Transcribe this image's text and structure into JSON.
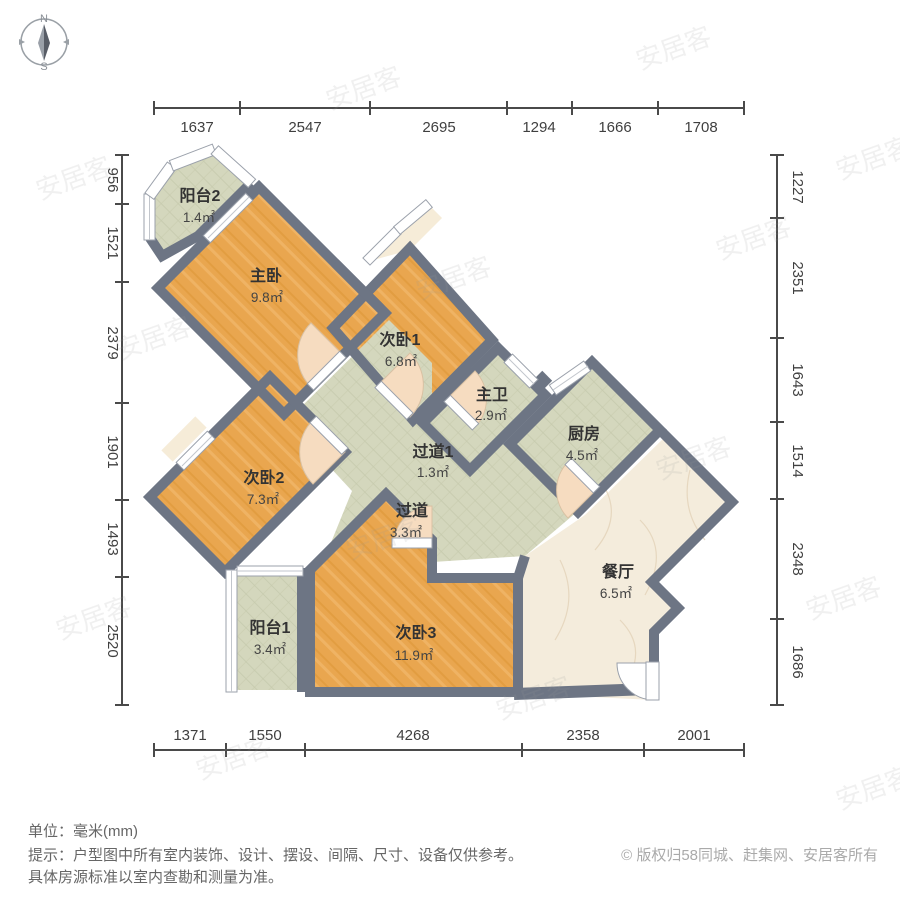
{
  "compass": {
    "north": "N",
    "south": "S"
  },
  "dimensions": {
    "top": [
      "1637",
      "2547",
      "2695",
      "1294",
      "1666",
      "1708"
    ],
    "left": [
      "956",
      "1521",
      "2379",
      "1901",
      "1493",
      "2520"
    ],
    "right": [
      "1227",
      "2351",
      "1643",
      "1514",
      "2348",
      "1686"
    ],
    "bottom": [
      "1371",
      "1550",
      "4268",
      "2358",
      "2001"
    ]
  },
  "rooms": [
    {
      "name": "阳台2",
      "area": "1.4㎡"
    },
    {
      "name": "主卧",
      "area": "9.8㎡"
    },
    {
      "name": "次卧1",
      "area": "6.8㎡"
    },
    {
      "name": "主卫",
      "area": "2.9㎡"
    },
    {
      "name": "厨房",
      "area": "4.5㎡"
    },
    {
      "name": "过道1",
      "area": "1.3㎡"
    },
    {
      "name": "过道",
      "area": "3.3㎡"
    },
    {
      "name": "次卧2",
      "area": "7.3㎡"
    },
    {
      "name": "餐厅",
      "area": "6.5㎡"
    },
    {
      "name": "阳台1",
      "area": "3.4㎡"
    },
    {
      "name": "次卧3",
      "area": "11.9㎡"
    }
  ],
  "footer": {
    "unit": "单位：毫米(mm)",
    "tip1": "提示：户型图中所有室内装饰、设计、摆设、间隔、尺寸、设备仅供参考。",
    "tip2": "具体房源标准以室内查勘和测量为准。",
    "copyright": "© 版权归58同城、赶集网、安居客所有"
  },
  "watermark": {
    "text": "安居客"
  },
  "colors": {
    "wall": "#6d7584",
    "wood_light": "#f1b168",
    "wood_dark": "#de9337",
    "tile": "#d4d7bd",
    "marble": "#f4ecdc",
    "door": "#f6dcc0"
  }
}
